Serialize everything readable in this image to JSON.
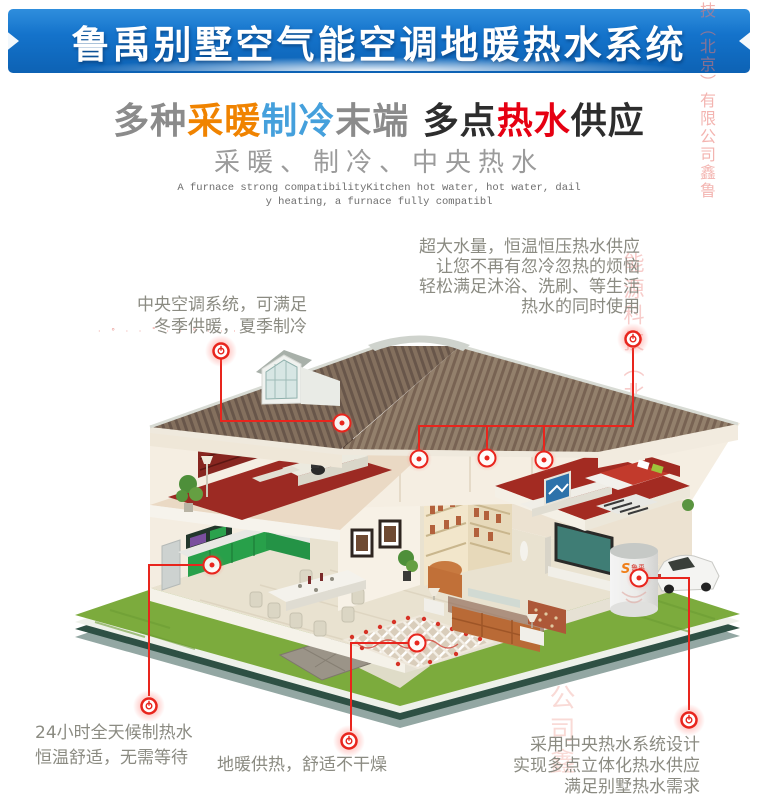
{
  "banner": {
    "title": "鲁禹别墅空气能空调地暖热水系统"
  },
  "headline": {
    "segments": [
      {
        "text": "多种",
        "color": "#8b8b8b"
      },
      {
        "text": "采暖",
        "color": "#f08300"
      },
      {
        "text": "制冷",
        "color": "#45a0dc"
      },
      {
        "text": "末端 ",
        "color": "#8b8b8b"
      },
      {
        "text": "多点",
        "color": "#2d2d2d"
      },
      {
        "text": "热水",
        "color": "#e60012"
      },
      {
        "text": "供应",
        "color": "#2d2d2d"
      }
    ]
  },
  "subtitle": "采暖、制冷、中央热水",
  "english_caption": {
    "line1": "A furnace strong compatibilityKitchen hot water, hot water, dail",
    "line2": "y heating, a furnace fully compatibl"
  },
  "callouts": {
    "hot_water_supply": {
      "line1": "超大水量，恒温恒压热水供应",
      "line2": "让您不再有忽冷忽热的烦恼",
      "line3": "轻松满足沐浴、洗刷、等生活",
      "line4": "热水的同时使用"
    },
    "central_ac": {
      "line1": "中央空调系统，可满足",
      "line2": "冬季供暖，夏季制冷"
    },
    "allday_hot_water": {
      "line1": "24小时全天候制热水",
      "line2": "恒温舒适，无需等待"
    },
    "floor_heating": {
      "line1": "地暖供热，舒适不干燥"
    },
    "central_hot_water_design": {
      "line1": "采用中央热水系统设计",
      "line2": "实现多点立体化热水供应",
      "line3": "满足别墅热水需求"
    }
  },
  "watermarks": {
    "column_right_top": "技（北京）有限公司鑫鲁",
    "column_right_mid": "能源科技（北京）有限公司鑫",
    "column_bottom": "公司鑫",
    "dots_top_left": "· ° · · ˚ · · ° · · · ·"
  },
  "tank": {
    "brand": "鲁禹"
  },
  "colors": {
    "banner_blue": "#1473cb",
    "accent_red": "#e8251d",
    "callout_text": "#8b8b82",
    "headline_orange": "#f08300",
    "headline_blue": "#45a0dc",
    "headline_red": "#e60012",
    "roof_brown": "#87725f",
    "grass_green": "#7cab3d"
  }
}
